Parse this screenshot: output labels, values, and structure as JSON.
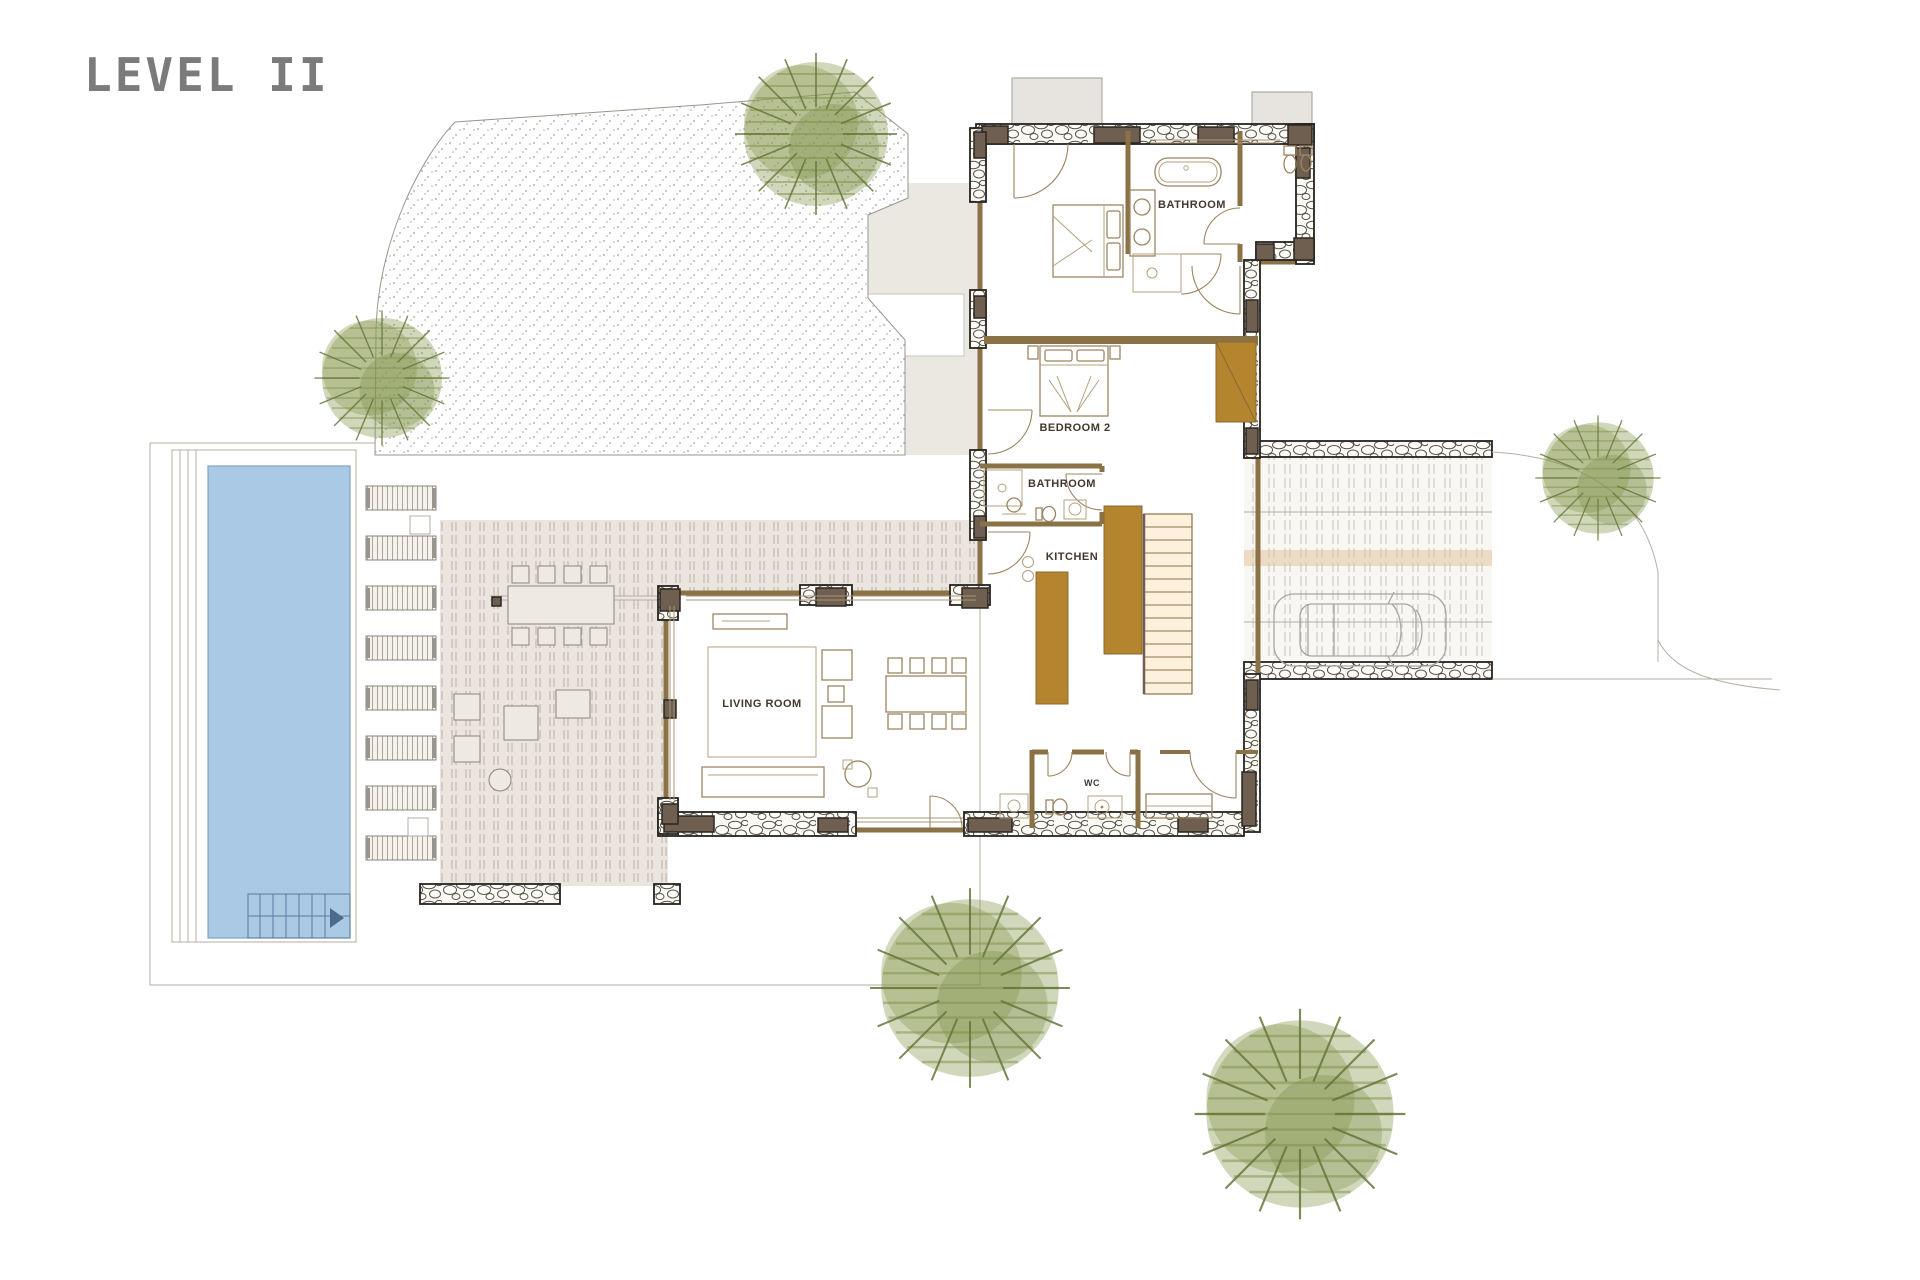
{
  "title": "LEVEL II",
  "labels": {
    "bathroom_main": "BATHROOM",
    "bedroom2": "BEDROOM 2",
    "bathroom_ensuite": "BATHROOM",
    "kitchen": "KITCHEN",
    "living_room": "LIVING ROOM",
    "wc": "WC"
  },
  "palette": {
    "floor": "#fbe3c6",
    "wall": "#8a7146",
    "wood": "#b4842e",
    "dark": "#6e5f50",
    "pool": "#a9c9e5",
    "terrace": "#ebe7e1",
    "deckbg": "#eae6df",
    "deckline": "#bdb5a9",
    "stonebg": "#fbf9f4",
    "tree": "#8a9a56",
    "treeline": "#66773a",
    "title": "#7b7b7b",
    "label": "#42382e"
  }
}
